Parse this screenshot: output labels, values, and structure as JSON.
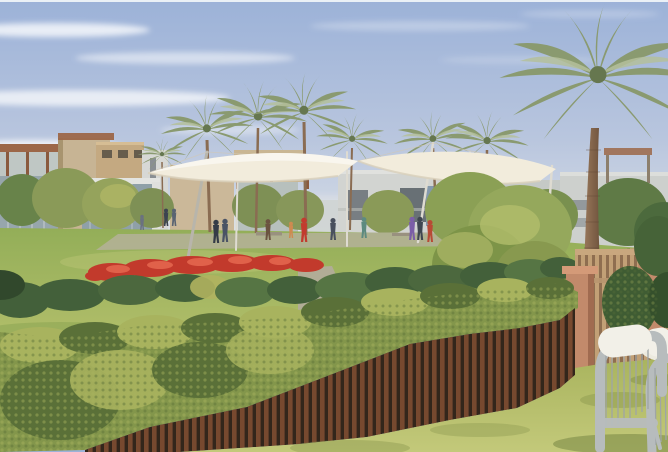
{
  "meta": {
    "title": "Architectural rendering of a landscaped community park with palm trees, shade canopy, flower beds, hedge-topped slat fence and garden seating",
    "type": "natural-image-rendering",
    "width": 668,
    "height": 452
  },
  "palette": {
    "sky_top": "#9cb2d8",
    "sky_mid": "#b9c6de",
    "sky_horizon": "#dde2e8",
    "cloud": "#ffffff",
    "building_beige": "#c7b494",
    "building_tan": "#c4a981",
    "building_grey": "#cdd0cd",
    "building_glass": "#8fa0a8",
    "building_dark": "#5a6168",
    "pergola": "#9c6748",
    "palm_main": "#8a9a70",
    "palm_light": "#b4bf9b",
    "palm_dark": "#66774f",
    "trunk_light": "#9b7a5c",
    "trunk_dark": "#6b4f3a",
    "canopy": "#f2ecdc",
    "canopy_shade": "#cfc8b8",
    "mast": "#dedbd1",
    "lawn_light": "#b5c06c",
    "lawn_mid": "#93ae58",
    "lawn_dark": "#7d9a4c",
    "paving": "#b8b1a1",
    "flower_red": "#c23a2c",
    "flower_red_light": "#e0614a",
    "shrub_dark": "#43603a",
    "shrub_mid": "#68834a",
    "shrub_yellow": "#b0b25f",
    "hedge_light": "#a8b35e",
    "hedge_mid": "#83964b",
    "hedge_dark": "#5a7038",
    "fence_wood": "#77492f",
    "fence_shadow": "#33261b",
    "fence_tan": "#c2a076",
    "fence_tan_dark": "#8f6e50",
    "pillar": "#c28a6b",
    "pillar_light": "#d49a78",
    "chair_frame": "#b7bcbd",
    "chair_rope": "#9fa5a6",
    "cushion": "#f2f0e8",
    "table": "#eceadf",
    "grass_fore": "#a9b45e",
    "grass_fore_light": "#c3c97a",
    "grass_fore_dark": "#7e8c44",
    "shadow_green": "#6f7f3e"
  },
  "scene": {
    "sky": {
      "label": "pale blue sky with wispy clouds"
    },
    "buildings": {
      "label": "low-rise beige and grey villas with pergola roofs"
    },
    "canopy": {
      "label": "white tensile shade canopy on slim masts"
    },
    "palms": {
      "label": "date palm trees",
      "count": 8
    },
    "lawn": {
      "label": "community park lawn with paved plaza"
    },
    "flower_bed": {
      "label": "red flower bed between shrubs"
    },
    "hedge": {
      "label": "bright green foreground hedge"
    },
    "fence": {
      "label": "brown timber slat fence under the hedge"
    },
    "right_fence": {
      "label": "tall tan privacy fence with terracotta pillars"
    },
    "furniture": {
      "label": "grey rope garden chairs with white cushions and round table"
    },
    "people": [
      {
        "label": "walker",
        "color": "#6a7180"
      },
      {
        "label": "walker",
        "color": "#3c4350"
      },
      {
        "label": "walker",
        "color": "#5a6472"
      },
      {
        "label": "stander",
        "color": "#343b47"
      },
      {
        "label": "stander",
        "color": "#4a5365"
      },
      {
        "label": "bench-sitter",
        "color": "#6b5340"
      },
      {
        "label": "bench-sitter",
        "color": "#cf8a50"
      },
      {
        "label": "stander-red-shirt",
        "color": "#c23b2e"
      },
      {
        "label": "stander",
        "color": "#49505e"
      },
      {
        "label": "stander",
        "color": "#5d8a80"
      },
      {
        "label": "walker",
        "color": "#7b5ea7"
      },
      {
        "label": "walker",
        "color": "#3f4650"
      },
      {
        "label": "walker-red-shirt",
        "color": "#b84a35"
      }
    ]
  }
}
